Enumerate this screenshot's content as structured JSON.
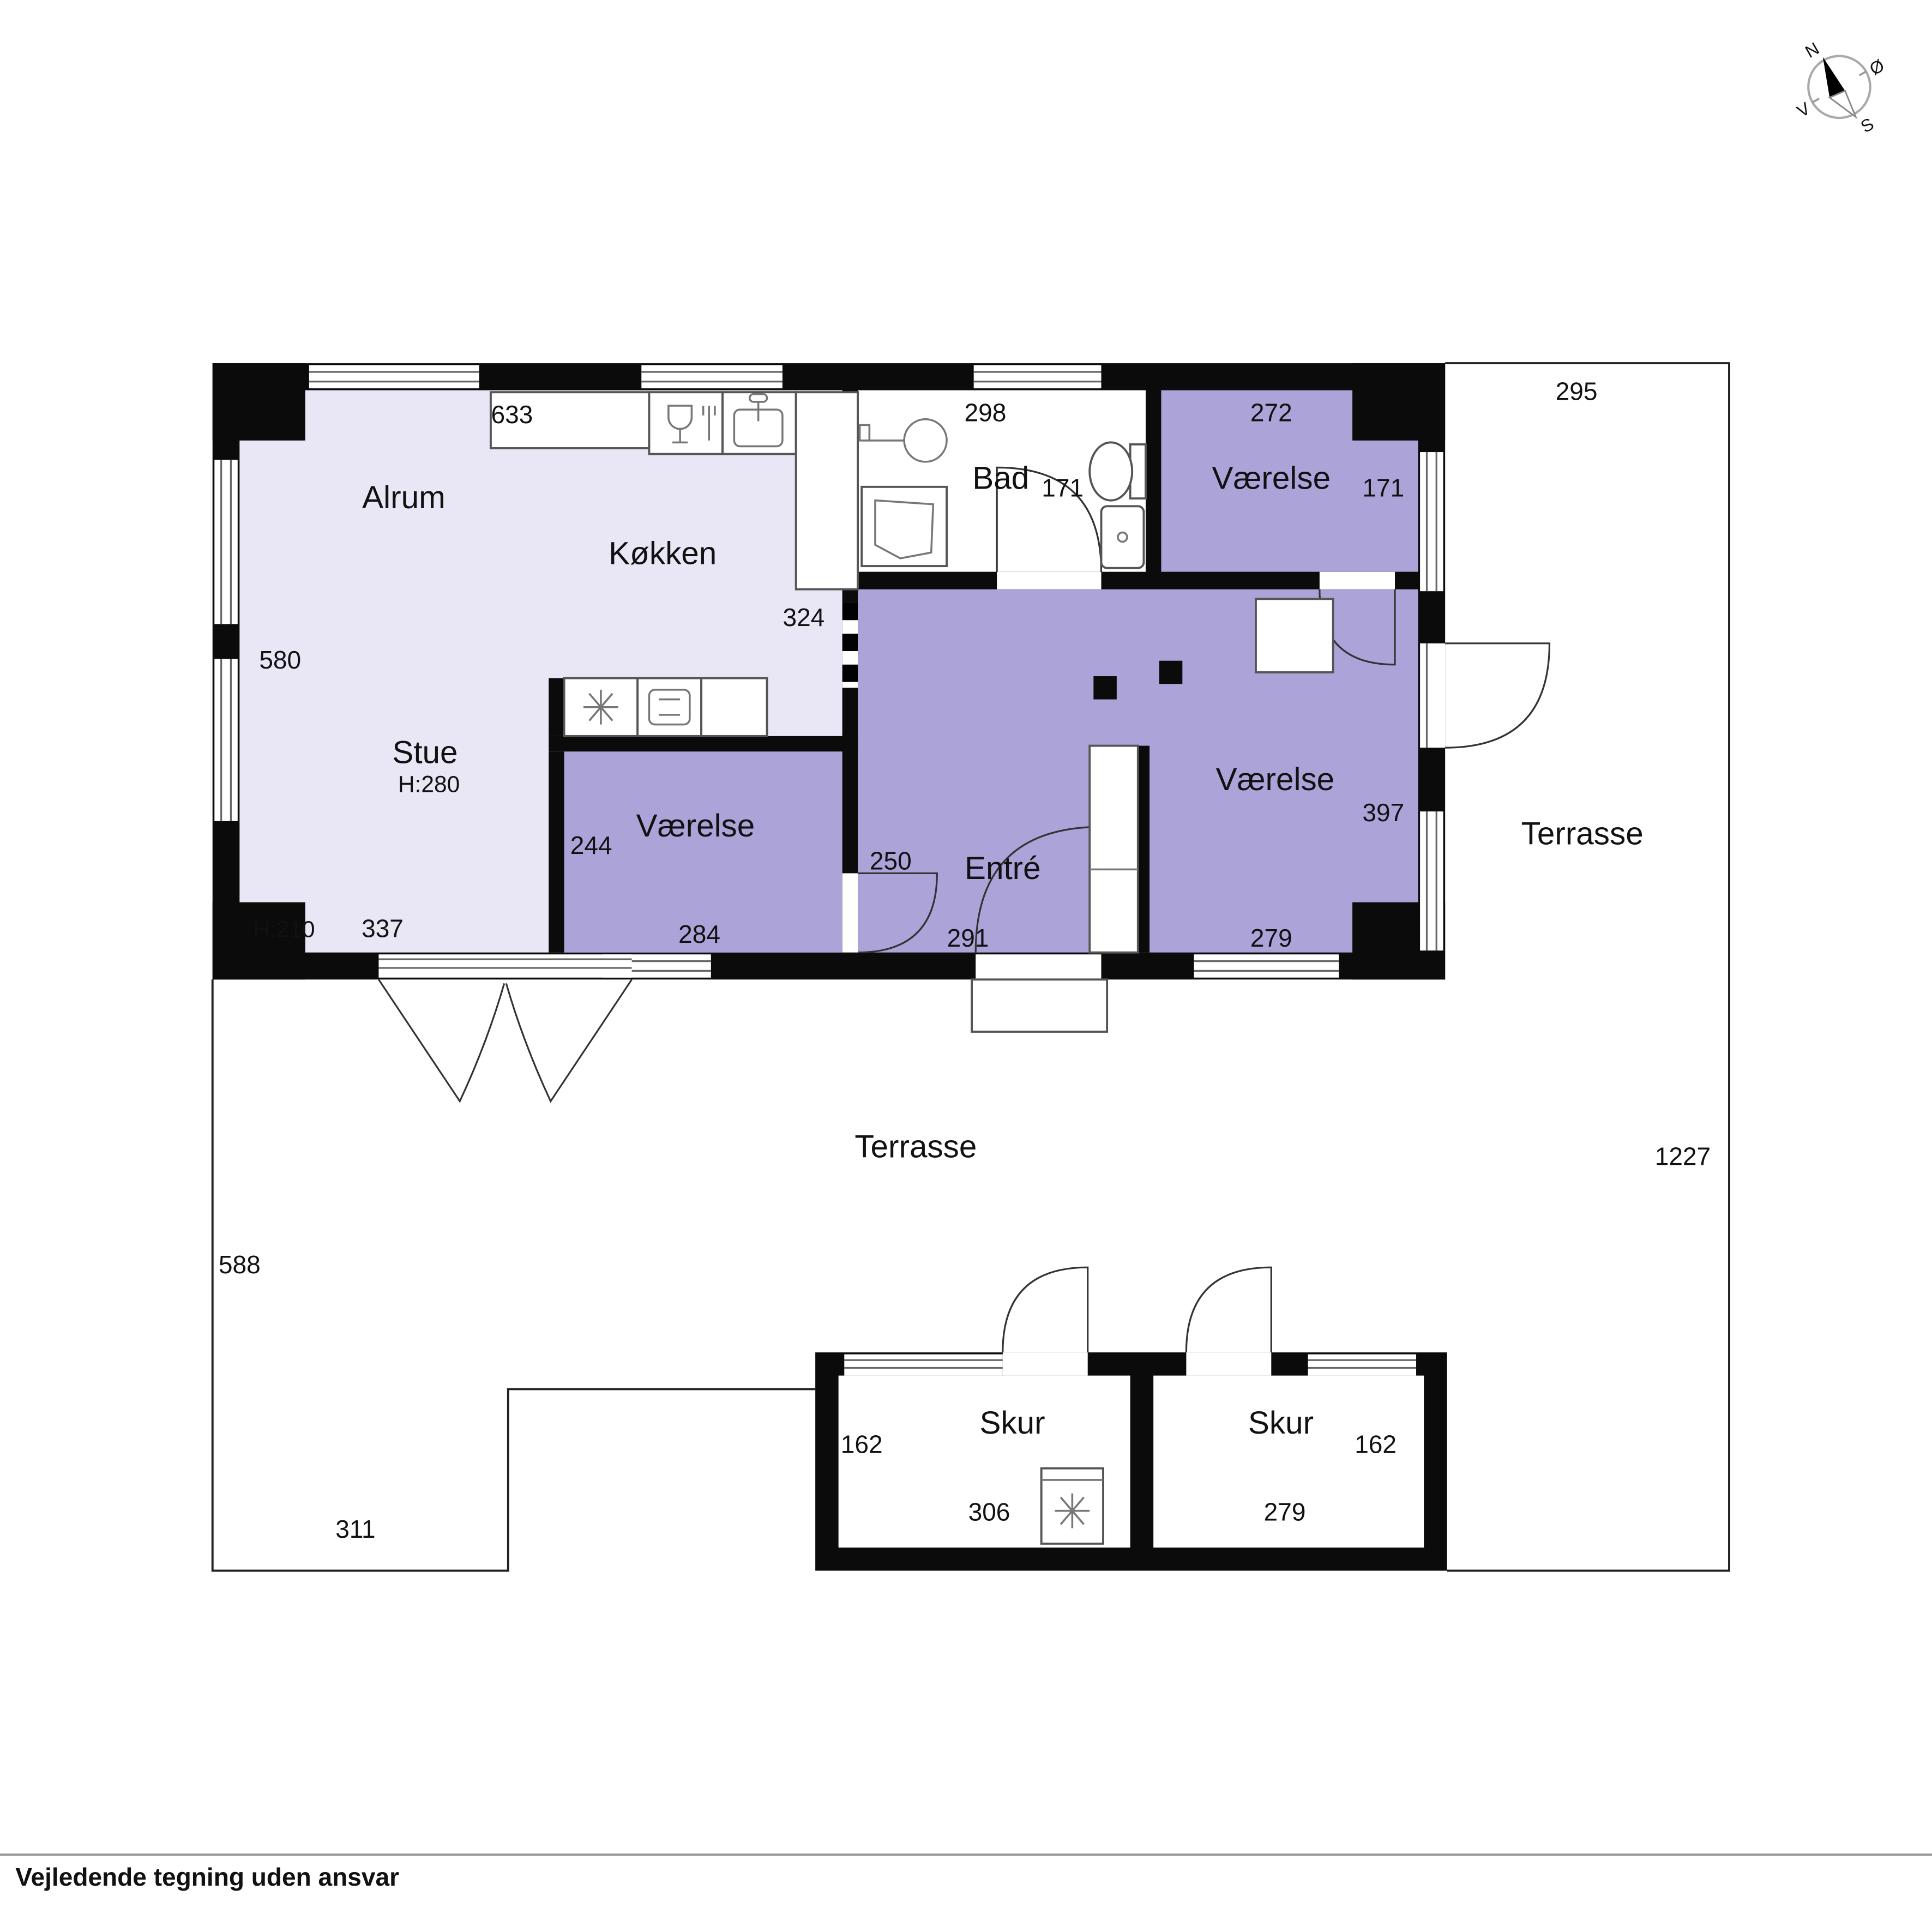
{
  "colors": {
    "wall": "#0b0b0b",
    "room_light": "#E9E6F6",
    "room_purple": "#ACA3D8",
    "paper": "#ffffff",
    "line": "#222222"
  },
  "compass": {
    "n": "N",
    "e": "Ø",
    "s": "S",
    "v": "V"
  },
  "plan": {
    "alrum": {
      "name": "Alrum",
      "width": "633",
      "height": "580"
    },
    "kokken": {
      "name": "Køkken",
      "opening": "324"
    },
    "stue": {
      "name": "Stue",
      "ceiling": "H:280",
      "ceiling_low": "H:210",
      "width": "337"
    },
    "vaerelse_small": {
      "name": "Værelse",
      "depth": "244",
      "width": "284"
    },
    "bad": {
      "name": "Bad",
      "width": "298",
      "depth": "171"
    },
    "vaerelse_top": {
      "name": "Værelse",
      "width": "272",
      "depth": "171"
    },
    "entre": {
      "name": "Entré",
      "side": "250",
      "width": "291"
    },
    "vaerelse_right": {
      "name": "Værelse",
      "depth": "397",
      "width": "279"
    },
    "terrasse_right": {
      "name": "Terrasse",
      "width": "295",
      "length": "1227"
    },
    "terrasse_bottom": {
      "name": "Terrasse",
      "left": "588",
      "bottom": "311"
    },
    "skur_left": {
      "name": "Skur",
      "depth": "162",
      "width": "306"
    },
    "skur_right": {
      "name": "Skur",
      "depth": "162",
      "width": "279"
    }
  },
  "footer": {
    "disclaimer": "Vejledende tegning uden ansvar"
  }
}
